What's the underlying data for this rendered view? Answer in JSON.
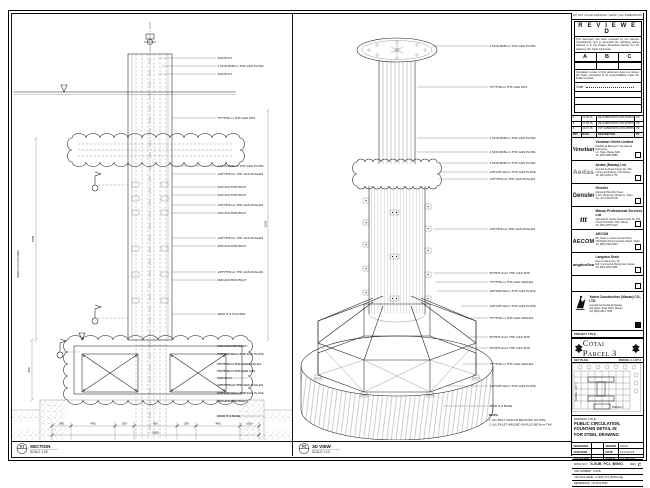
{
  "sec": {
    "num": "01",
    "title": "SECTION",
    "scale": "SCALE 1:25",
    "labels": [
      "M20 BOLT",
      "4 NOS Ø25mm THK G&S PLATE",
      "M20 BOLT",
      "75*75*6mm THK G&S SHS",
      "4 NOS Ø25mm THK G&S PLATE",
      "125*75*8mm THK G&S ANGLES",
      "M20 ANCHOR BOLT",
      "M20 ANCHOR BOLT",
      "125*75*8mm THK G&S ANGLES",
      "M20 ANCHOR BOLT",
      "125*75*8mm THK G&S ANGLES",
      "M20 ANCHOR BOLT",
      "125*75*8mm THK G&S ANGLES",
      "M20 ANCHOR BOLT",
      "Ø200 H.S COLUMN",
      "M20 ANCHOR BOLT",
      "400*200*20mm THK G&S PLATE",
      "75*75*8mm THK G&S ANGLES",
      "75*75*8mm THK G&S SHS",
      "M20 BOLT",
      "125*75*8mm THK G&S ANGLES",
      "125*125*12mm THK G&S PLATE",
      "M20 ANCHOR BOLT",
      "Ø200 H.S BASE"
    ],
    "dims": [
      "200",
      "465",
      "200",
      "450",
      "200",
      "465",
      "200"
    ],
    "dim_total": "2180",
    "dim_left_upper": "1585",
    "dim_left_lower": "600",
    "dim_right": "2265",
    "margin_label": "Ø200 H.S COLUMN"
  },
  "iso": {
    "num": "02",
    "title": "3D VIEW",
    "scale": "SCALE 1:10",
    "labels": [
      "4 NOS Ø25mm THK G&S PLATE",
      "75*75*6mm THK G&S SHS",
      "4 NOS Ø25mm THK G&S PLATE",
      "4 NOS Ø25mm THK G&S PLATE",
      "4 NOS Ø25mm THK G&S PLATE",
      "125*125*12mm THK G&S PLATE",
      "125*75*8mm THK G&S ANGLES",
      "125*75*8mm THK G&S ANGLES",
      "50*50*5.4mm THK G&S SHS",
      "75*75*8mm THK G&S ANGLES",
      "400*200*20mm THK G&S PLATE",
      "125*125*12mm THK G&S PLATE",
      "75*75*8mm THK G&S ANGLES",
      "50*50*5.4mm THK G&S SHS",
      "50*50*5.4mm THK G&S SHS",
      "75*75*8mm THK G&S ANGLES",
      "125*125*12mm THK G&S PLATE",
      "Ø200 H.S BASE"
    ],
    "note_title": "NOTE:",
    "notes": [
      "1. ALL BOLT SHOULD BE FIXING ON SITE.",
      "2. ALL FILLET WELDED SHOULD BE 6mm THK."
    ]
  },
  "tb": {
    "top_note": "DO NOT SCALE DRAWING. VERIFY ALL DIMENSIONS ON SITE.",
    "reviewed": {
      "title": "R E V I E W E D",
      "para1": "This document has been reviewed by the relevant Consultant(s) and is accorded the following status referred to in the Project Procedure Section 5.4 for action by the Trade Contractor.",
      "s1": "A",
      "s2": "B",
      "s3": "C",
      "para2": "Consultant review of this document does not relieve the Trade Contractor of its responsibilities under the Trade Contract.",
      "date_label": "Date :"
    },
    "revs": {
      "header": {
        "no": "REV",
        "date": "DATE",
        "desc": "DESCRIPTION",
        "by": "BY"
      },
      "rows": [
        {
          "no": "C",
          "date": "21-08-15",
          "desc": "RE-SUBMISSION FOR APPROVAL",
          "by": "PC"
        },
        {
          "no": "B",
          "date": "07-08-15",
          "desc": "RE-SUBMISSION FOR APPROVAL",
          "by": "PC"
        },
        {
          "no": "A",
          "date": "24-07-15",
          "desc": "1ST SUBMISSION FOR APPROVAL",
          "by": "PC"
        }
      ]
    },
    "companies": [
      {
        "logo": "Venetian",
        "name": "Venetian Orient Limited",
        "a1": "Estrada da Baía de N. Senhora da Esperança,",
        "a2": "s/n, Taipa, Macau SAR",
        "a3": "Tel: (853) 2882 8888"
      },
      {
        "logo": "Aedas",
        "name": "Aedas (Macau) Ltd.",
        "a1": "Avenida da Praia Grande No. 409,",
        "a2": "China Law Building, 21/F, Macau",
        "a3": "Tel: (853) 2833 1778"
      },
      {
        "logo": "Gensler",
        "name": "Gensler",
        "a1": "Roppongi Hills Mori Tower,",
        "a2": "6-10-1 Roppongi, Minato-ku, Tokyo",
        "a3": "Tel: +81 3 6402 5700"
      },
      {
        "logo": "ttt",
        "name": "Macau Professional Services Ltd.",
        "a1": "Alameda Dr. Carlos d'Assumpção No. 263,",
        "a2": "China Civil Plaza, 16/F, Macau",
        "a3": "Tel: (853) 2875 3215"
      },
      {
        "logo": "AECOM",
        "name": "AECOM",
        "a1": "8/F, Tower 2, Grand Central Plaza,",
        "a2": "138 Shatin Rural Committee Road, Shatin",
        "a3": "Tel: (852) 3922 9000"
      },
      {
        "logo": "LangdonSeah",
        "name": "Langdon Seah",
        "a1": "Rua do Campo No. 78,",
        "a2": "Edf. Commercial Zhang Kian, Macau",
        "a3": "Tel: (853) 2833 3088"
      }
    ],
    "contractor": {
      "name": "Yadea Construction (Macau) CO., LTD.",
      "a1": "Avenida Comercial de Macau,",
      "a2": "AIA Tower, Suite 1807, Macau",
      "a3": "Tel: (853) 2871 7233"
    },
    "project_title_label": "PROJECT TITLE",
    "project_title": "Cotai Parcel 3",
    "keyplan": {
      "label": "KEY PLAN",
      "parcel": "PARCEL 1, LOT 2",
      "side": "PARCEL 1, LOT 1",
      "bottom": "PARCEL 3"
    },
    "drawing_title_label": "DRAWING TITLE:",
    "dt1": "PUBLIC CIRCULATION,",
    "dt2": "FOUNTAIN DETAIL IN",
    "dt3": "FOR STEEL DRAWING",
    "sign": {
      "r1c1": "DESIGNED",
      "r1c2": "",
      "r1c3": "DRAWN",
      "r1c4": "CHAO",
      "r2c1": "CHECKED",
      "r2c2": "-",
      "r2c3": "DATE",
      "r2c4": "14-AUG-15",
      "r3c1": "APPROVED",
      "r3c2": "-",
      "r3c3": "SCALE",
      "r3c4": "AS SHOWN"
    },
    "dwg_label": "DWG NO :",
    "dwg_no": "S-SUB_PC1_B0001",
    "rev_label": "REV",
    "rev": "C",
    "cad_number_label": "CAD NUMBER :",
    "cad_number": "S-SUB",
    "cad_file_label": "CAD FILE NAME :",
    "cad_file": "S-SUB_PC1_B0001.dwg",
    "ref_label": "REFERENCE :",
    "ref": "ON FILE 9000"
  }
}
